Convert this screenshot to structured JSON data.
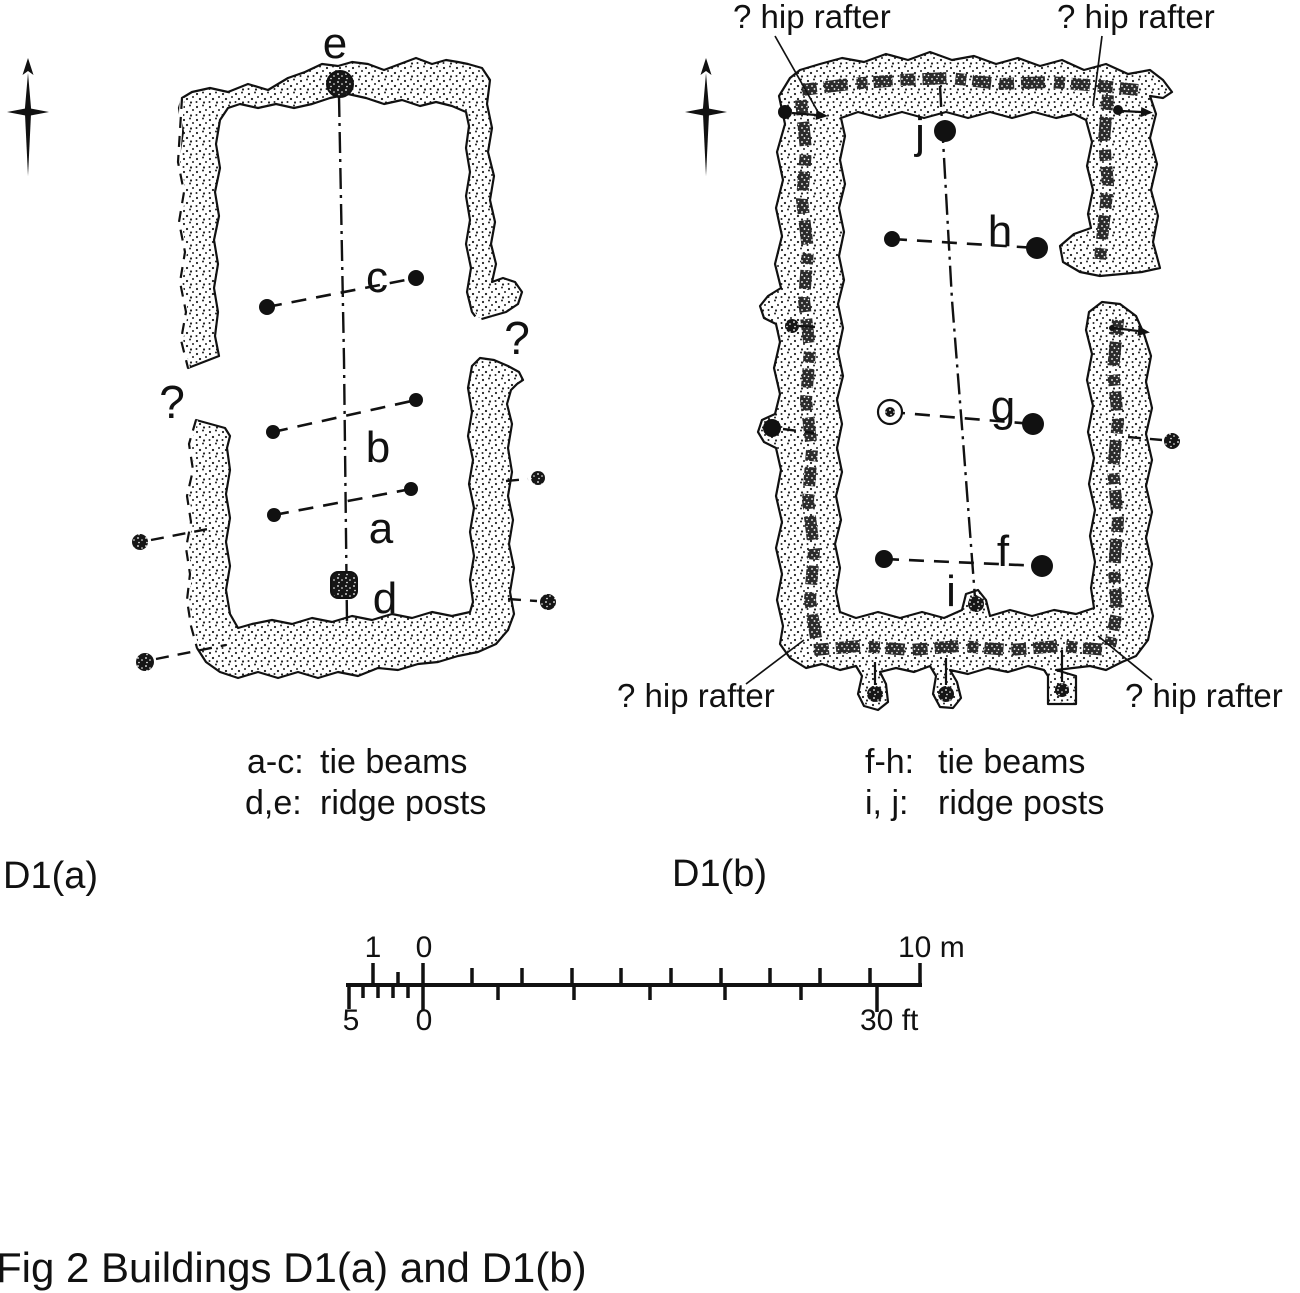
{
  "caption": "Fig 2 Buildings D1(a) and D1(b)",
  "building_a": {
    "name": "D1(a)",
    "legend": {
      "row1_key": "a-c:",
      "row1_val": "tie beams",
      "row2_key": "d,e:",
      "row2_val": "ridge posts"
    }
  },
  "building_b": {
    "name": "D1(b)",
    "legend": {
      "row1_key": "f-h:",
      "row1_val": "tie beams",
      "row2_key": "i, j:",
      "row2_val": "ridge posts"
    }
  },
  "scale_bar": {
    "meters_one": "1",
    "meters_zero": "0",
    "meters_max": "10 m",
    "feet_five": "5",
    "feet_zero": "0",
    "feet_max": "30 ft"
  },
  "plan": {
    "buildings": [
      {
        "group": "building-a-dynamic",
        "ridge_line": [
          [
            339,
            96
          ],
          [
            344,
            360
          ],
          [
            347,
            622
          ]
        ],
        "tie_beams": [
          {
            "label": "c",
            "label_pos": [
              377,
              292
            ],
            "posts": [
              {
                "x": 267,
                "y": 307,
                "r": 8
              },
              {
                "x": 416,
                "y": 278,
                "r": 8
              }
            ]
          },
          {
            "label": "b",
            "label_pos": [
              378,
              462
            ],
            "posts": [
              {
                "x": 273,
                "y": 432,
                "r": 7
              },
              {
                "x": 416,
                "y": 400,
                "r": 7
              }
            ]
          },
          {
            "label": "a",
            "label_pos": [
              381,
              543
            ],
            "posts": [
              {
                "x": 274,
                "y": 515,
                "r": 7
              },
              {
                "x": 411,
                "y": 489,
                "r": 7
              }
            ]
          }
        ],
        "ridge_posts": [
          {
            "label": "e",
            "label_pos": [
              335,
              58
            ],
            "x": 340,
            "y": 84,
            "r": 13,
            "shape": "circle"
          },
          {
            "label": "d",
            "label_pos": [
              385,
              613
            ],
            "x": 344,
            "y": 585,
            "r": 13,
            "shape": "square"
          }
        ],
        "exterior_posts": [
          {
            "x": 140,
            "y": 542,
            "r": 8,
            "type": "fuzzy",
            "line": [
              [
                151,
                540
              ],
              [
                213,
                528
              ]
            ]
          },
          {
            "x": 145,
            "y": 662,
            "r": 9,
            "type": "fuzzy",
            "line": [
              [
                156,
                659
              ],
              [
                226,
                645
              ]
            ]
          },
          {
            "x": 538,
            "y": 478,
            "r": 7,
            "type": "fuzzy",
            "line": [
              [
                506,
                481
              ],
              [
                528,
                479
              ]
            ]
          },
          {
            "x": 548,
            "y": 602,
            "r": 8,
            "type": "fuzzy",
            "line": [
              [
                508,
                599
              ],
              [
                537,
                601
              ]
            ]
          }
        ],
        "annotations": [
          {
            "text": "?",
            "x": 172,
            "y": 418,
            "size": 46,
            "anchor": "middle"
          },
          {
            "text": "?",
            "x": 517,
            "y": 354,
            "size": 46,
            "anchor": "middle"
          }
        ]
      },
      {
        "group": "building-b-dynamic",
        "ridge_line": [
          [
            940,
            86
          ],
          [
            952,
            300
          ],
          [
            963,
            440
          ],
          [
            975,
            598
          ]
        ],
        "tie_beams": [
          {
            "label": "h",
            "label_pos": [
              1000,
              246
            ],
            "posts": [
              {
                "x": 892,
                "y": 239,
                "r": 8
              },
              {
                "x": 1037,
                "y": 248,
                "r": 11
              }
            ]
          },
          {
            "label": "g",
            "label_pos": [
              1003,
              421
            ],
            "posts": [
              {
                "x": 890,
                "y": 412,
                "r": 7,
                "type": "open"
              },
              {
                "x": 1033,
                "y": 424,
                "r": 11
              }
            ]
          },
          {
            "label": "f",
            "label_pos": [
              1003,
              566
            ],
            "posts": [
              {
                "x": 884,
                "y": 559,
                "r": 9
              },
              {
                "x": 1042,
                "y": 566,
                "r": 11
              }
            ]
          }
        ],
        "ridge_posts": [
          {
            "label": "j",
            "label_pos": [
              920,
              148
            ],
            "x": 945,
            "y": 131,
            "r": 11,
            "shape": "black"
          },
          {
            "label": "i",
            "label_pos": [
              951,
              606
            ],
            "x": 976,
            "y": 604,
            "r": 8,
            "shape": "fuzzy"
          }
        ],
        "exterior_posts": [
          {
            "x": 772,
            "y": 428,
            "r": 9,
            "type": "black",
            "line": [
              [
                783,
                429
              ],
              [
                814,
                433
              ]
            ]
          },
          {
            "x": 1172,
            "y": 441,
            "r": 8,
            "type": "fuzzy",
            "line": [
              [
                1128,
                437
              ],
              [
                1162,
                440
              ]
            ]
          },
          {
            "x": 785,
            "y": 112,
            "r": 7,
            "type": "black",
            "line": [
              [
                792,
                113
              ],
              [
                816,
                115
              ]
            ],
            "arrow": true,
            "solid": true
          },
          {
            "x": 1118,
            "y": 110,
            "r": 5,
            "type": "black",
            "line": [
              [
                1122,
                111
              ],
              [
                1141,
                112
              ]
            ],
            "arrow": true,
            "solid": true
          },
          {
            "x": 792,
            "y": 326,
            "r": 7,
            "type": "fuzzy",
            "line": [
              [
                799,
                326
              ],
              [
                815,
                327
              ]
            ],
            "solid": true
          },
          {
            "x": 1112,
            "y": 328,
            "r": 3,
            "type": "black",
            "line": [
              [
                1114,
                328
              ],
              [
                1138,
                331
              ]
            ],
            "arrow": true,
            "solid": true
          },
          {
            "x": 875,
            "y": 694,
            "r": 8,
            "type": "fuzzy",
            "line": [
              [
                875,
                662
              ],
              [
                875,
                685
              ]
            ],
            "solid": true
          },
          {
            "x": 946,
            "y": 694,
            "r": 8,
            "type": "fuzzy",
            "line": [
              [
                946,
                658
              ],
              [
                946,
                685
              ]
            ],
            "solid": true
          },
          {
            "x": 1062,
            "y": 690,
            "r": 7,
            "type": "fuzzy",
            "line": [
              [
                1062,
                650
              ],
              [
                1062,
                682
              ]
            ],
            "solid": true
          }
        ],
        "annotations": [
          {
            "text": "? hip rafter",
            "x": 733,
            "y": 28,
            "size": 33,
            "anchor": "start",
            "leader": [
              [
                775,
                36
              ],
              [
                818,
                112
              ]
            ]
          },
          {
            "text": "? hip rafter",
            "x": 1057,
            "y": 28,
            "size": 33,
            "anchor": "start",
            "leader": [
              [
                1102,
                36
              ],
              [
                1093,
                106
              ]
            ]
          },
          {
            "text": "? hip rafter",
            "x": 617,
            "y": 707,
            "size": 33,
            "anchor": "start",
            "leader": [
              [
                746,
                684
              ],
              [
                804,
                640
              ]
            ]
          },
          {
            "text": "? hip rafter",
            "x": 1125,
            "y": 707,
            "size": 33,
            "anchor": "start",
            "leader": [
              [
                1152,
                680
              ],
              [
                1098,
                636
              ]
            ]
          }
        ]
      }
    ]
  }
}
